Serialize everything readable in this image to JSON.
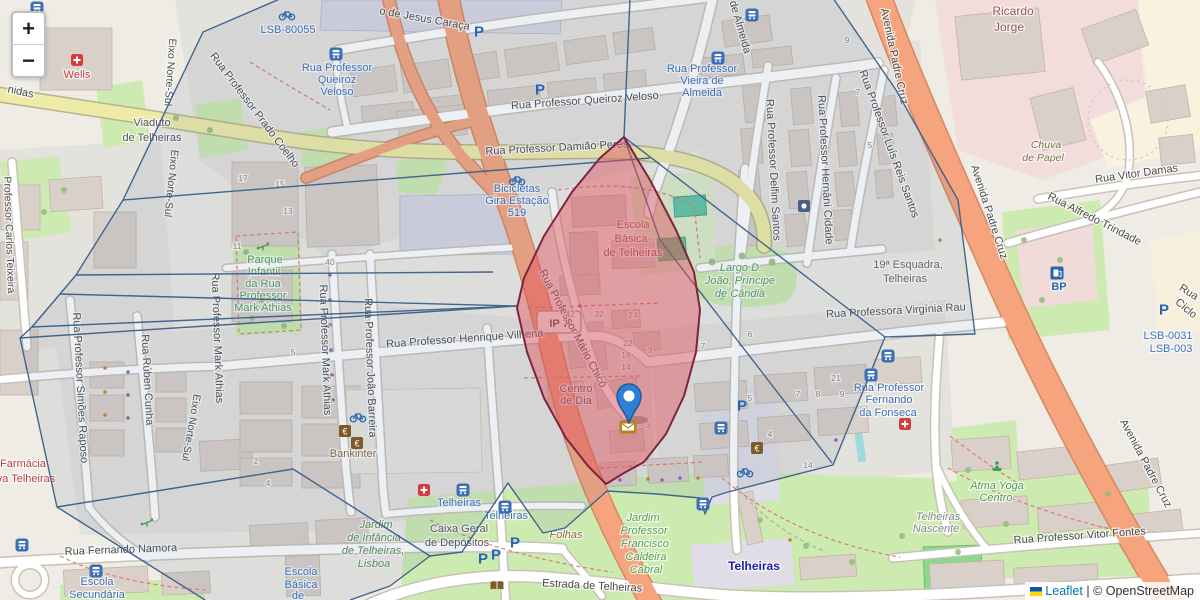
{
  "controls": {
    "zoom_in": "+",
    "zoom_out": "−"
  },
  "attribution": {
    "leaflet": "Leaflet",
    "separator": "|",
    "copyright": "© OpenStreetMap"
  },
  "marker": {
    "x": 629,
    "y": 423
  },
  "colors": {
    "street": "#4b4b4b",
    "blue": "#3b6fb6",
    "green": "#4f9e4f",
    "metro": "#2020a8",
    "gray": "#666666",
    "num": "#8a8a80",
    "red": "#c04040",
    "place": "#a05252",
    "brown": "#8a6d3b",
    "school": "#995233",
    "olive": "#7a7340",
    "dkgray": "#555555",
    "graylt": "#888888",
    "pblue": "#2864b4",
    "grn2": "#5a8a52",
    "overlay_line": "#3a5f8a",
    "highlight_fill": "rgba(226,80,92,0.45)",
    "highlight_border": "#7d2440"
  },
  "map_labels": [
    {
      "t": "nidas",
      "x": 20,
      "y": 95,
      "r": 12
    },
    {
      "t": "Viaduto",
      "x": 152,
      "y": 126,
      "c": "dkgray"
    },
    {
      "t": "de Telheiras",
      "x": 152,
      "y": 141,
      "c": "dkgray"
    },
    {
      "t": "Eixo Norte-Sul",
      "x": 167,
      "y": 72,
      "r": 94,
      "s": 10.5
    },
    {
      "t": "Eixo Norte-Sul",
      "x": 168,
      "y": 183,
      "r": 96,
      "s": 10.5
    },
    {
      "t": "Eixo Norte-Sul",
      "x": 188,
      "y": 427,
      "r": 100,
      "s": 10.5
    },
    {
      "t": "Rua Professor Prado Coelho",
      "x": 252,
      "y": 112,
      "r": 53
    },
    {
      "t": "Rua Professor",
      "x": 337,
      "y": 71,
      "c": "blue"
    },
    {
      "t": "Queiroz",
      "x": 337,
      "y": 83,
      "c": "blue"
    },
    {
      "t": "Veloso",
      "x": 337,
      "y": 95,
      "c": "blue"
    },
    {
      "t": "o de Jesus Caraça",
      "x": 424,
      "y": 22,
      "r": 10
    },
    {
      "t": "Rua Professor Queiroz Veloso",
      "x": 585,
      "y": 104,
      "r": -4
    },
    {
      "t": "Rua Professor Damião Peres",
      "x": 557,
      "y": 151,
      "r": -3
    },
    {
      "t": "Bicicletas",
      "x": 517,
      "y": 192,
      "c": "blue"
    },
    {
      "t": "Gira Estação",
      "x": 517,
      "y": 204,
      "c": "blue"
    },
    {
      "t": "519",
      "x": 517,
      "y": 216,
      "c": "blue"
    },
    {
      "t": "Rua Professor",
      "x": 702,
      "y": 72,
      "c": "blue"
    },
    {
      "t": "Vieira de",
      "x": 702,
      "y": 84,
      "c": "blue"
    },
    {
      "t": "Almeida",
      "x": 702,
      "y": 96,
      "c": "blue"
    },
    {
      "t": "de Almeida",
      "x": 737,
      "y": 28,
      "r": 74
    },
    {
      "t": "Rua Professor Delfim Santos",
      "x": 770,
      "y": 170,
      "r": 87
    },
    {
      "t": "Rua Professor Hernâni Cidade",
      "x": 822,
      "y": 170,
      "r": 87
    },
    {
      "t": "Rua Professor Luís Reis Santos",
      "x": 886,
      "y": 145,
      "r": 70
    },
    {
      "t": "Avenida Padre Cruz",
      "x": 891,
      "y": 57,
      "r": 78
    },
    {
      "t": "Avenida Padre Cruz",
      "x": 986,
      "y": 213,
      "r": 72
    },
    {
      "t": "Avenida Padre Cruz",
      "x": 1143,
      "y": 465,
      "r": 62
    },
    {
      "t": "Ricardo",
      "x": 1013,
      "y": 15,
      "c": "place",
      "s": 12
    },
    {
      "t": "Jorge",
      "x": 1009,
      "y": 31,
      "c": "place",
      "s": 12
    },
    {
      "t": "Chuva",
      "x": 1046,
      "y": 148,
      "c": "olive",
      "i": 1,
      "s": 10.5
    },
    {
      "t": "de Papel",
      "x": 1043,
      "y": 161,
      "c": "olive",
      "i": 1,
      "s": 10.5
    },
    {
      "t": "Rua Vitor Damas",
      "x": 1137,
      "y": 177,
      "r": -8
    },
    {
      "t": "Rua Alfredo Trindade",
      "x": 1093,
      "y": 222,
      "r": 27
    },
    {
      "t": "Rua",
      "x": 1187,
      "y": 295,
      "r": 32
    },
    {
      "t": "Ciclo",
      "x": 1184,
      "y": 311,
      "r": 40
    },
    {
      "t": "LSB-0031",
      "x": 1168,
      "y": 339,
      "c": "blue"
    },
    {
      "t": "LSB-003",
      "x": 1171,
      "y": 352,
      "c": "blue"
    },
    {
      "t": "LSB-80055",
      "x": 288,
      "y": 33,
      "c": "blue"
    },
    {
      "t": "Wells",
      "x": 77,
      "y": 78,
      "c": "red"
    },
    {
      "t": "Farmácia",
      "x": 23,
      "y": 467,
      "c": "red"
    },
    {
      "t": "va Telheiras",
      "x": 26,
      "y": 482,
      "c": "red"
    },
    {
      "t": "IP 7",
      "x": 559,
      "y": 327,
      "c": "dkgray",
      "b": 1
    },
    {
      "t": "Parque",
      "x": 265,
      "y": 263,
      "c": "green"
    },
    {
      "t": "Infantil",
      "x": 264,
      "y": 275,
      "c": "green"
    },
    {
      "t": "da Rua",
      "x": 263,
      "y": 287,
      "c": "green"
    },
    {
      "t": "Professor",
      "x": 263,
      "y": 299,
      "c": "green"
    },
    {
      "t": "Mark Athias",
      "x": 263,
      "y": 311,
      "c": "green"
    },
    {
      "t": "Professor Carlos Teixeira",
      "x": 6,
      "y": 235,
      "r": 88,
      "s": 10.5
    },
    {
      "t": "Rua Professor Simões Raposo",
      "x": 77,
      "y": 388,
      "r": 87
    },
    {
      "t": "Rua Rúben Cunha",
      "x": 144,
      "y": 380,
      "r": 87
    },
    {
      "t": "Rua Professor Mark Athias",
      "x": 214,
      "y": 338,
      "r": 88
    },
    {
      "t": "Rua Professor Mark Athias",
      "x": 322,
      "y": 350,
      "r": 88
    },
    {
      "t": "Rua Professor João Barreira",
      "x": 367,
      "y": 368,
      "r": 88
    },
    {
      "t": "Rua Professor Henrique Vilhena",
      "x": 465,
      "y": 342,
      "r": -4
    },
    {
      "t": "Rua Professor Mário Chicó",
      "x": 570,
      "y": 330,
      "r": 62
    },
    {
      "t": "Centro",
      "x": 576,
      "y": 392,
      "c": "dkgray"
    },
    {
      "t": "de Dia",
      "x": 576,
      "y": 404,
      "c": "dkgray"
    },
    {
      "t": "Escola",
      "x": 633,
      "y": 228,
      "c": "school"
    },
    {
      "t": "· Básica ·",
      "x": 631,
      "y": 242,
      "c": "school"
    },
    {
      "t": "de Telheiras",
      "x": 633,
      "y": 256,
      "c": "school"
    },
    {
      "t": "Largo D.",
      "x": 741,
      "y": 271,
      "c": "green",
      "i": 1
    },
    {
      "t": "João, Príncipe",
      "x": 740,
      "y": 284,
      "c": "green",
      "i": 1
    },
    {
      "t": "de Cândia",
      "x": 740,
      "y": 297,
      "c": "green",
      "i": 1
    },
    {
      "t": "19ª Esquadra,",
      "x": 908,
      "y": 268,
      "c": "gray"
    },
    {
      "t": "Telheiras",
      "x": 905,
      "y": 282,
      "c": "gray"
    },
    {
      "t": "Rua Professora Virgínia Rau",
      "x": 896,
      "y": 314,
      "r": -3
    },
    {
      "t": "Rua Professor",
      "x": 889,
      "y": 391,
      "c": "blue"
    },
    {
      "t": "Fernando",
      "x": 889,
      "y": 403,
      "c": "blue"
    },
    {
      "t": "da Fonseca",
      "x": 888,
      "y": 416,
      "c": "blue"
    },
    {
      "t": "Atma Yoga",
      "x": 997,
      "y": 489,
      "c": "green",
      "i": 1
    },
    {
      "t": "Centro",
      "x": 996,
      "y": 501,
      "c": "green",
      "i": 1
    },
    {
      "t": "Telheiras",
      "x": 938,
      "y": 520,
      "c": "graylt",
      "i": 1
    },
    {
      "t": "Nascente",
      "x": 936,
      "y": 532,
      "c": "graylt",
      "i": 1
    },
    {
      "t": "Rua Professor Vitor Fontes",
      "x": 1080,
      "y": 539,
      "r": -4
    },
    {
      "t": "Rua Fernando Namora",
      "x": 121,
      "y": 553,
      "r": -2
    },
    {
      "t": "Escola",
      "x": 97,
      "y": 585,
      "c": "blue"
    },
    {
      "t": "Secundária",
      "x": 97,
      "y": 598,
      "c": "blue"
    },
    {
      "t": "Escola",
      "x": 301,
      "y": 575,
      "c": "blue"
    },
    {
      "t": "Básica",
      "x": 301,
      "y": 588,
      "c": "blue"
    },
    {
      "t": "de",
      "x": 298,
      "y": 599,
      "c": "blue"
    },
    {
      "t": "Jardim",
      "x": 376,
      "y": 528,
      "c": "grn2",
      "i": 1
    },
    {
      "t": "de Infância",
      "x": 374,
      "y": 541,
      "c": "grn2",
      "i": 1
    },
    {
      "t": "de Telheiras,",
      "x": 373,
      "y": 554,
      "c": "grn2",
      "i": 1
    },
    {
      "t": "Lisboa",
      "x": 374,
      "y": 567,
      "c": "grn2",
      "i": 1
    },
    {
      "t": "Caixa Geral",
      "x": 459,
      "y": 532,
      "c": "dkgray"
    },
    {
      "t": "de Depósitos",
      "x": 457,
      "y": 546,
      "c": "dkgray"
    },
    {
      "t": "Folhas",
      "x": 566,
      "y": 538,
      "c": "brown",
      "i": 1
    },
    {
      "t": "Estrada de Telheiras",
      "x": 592,
      "y": 589,
      "r": 3
    },
    {
      "t": "Telheiras",
      "x": 754,
      "y": 570,
      "c": "metro",
      "b": 1,
      "s": 12
    },
    {
      "t": "Telheiras",
      "x": 459,
      "y": 506,
      "c": "blue"
    },
    {
      "t": "Telheiras",
      "x": 506,
      "y": 519,
      "c": "blue"
    },
    {
      "t": "Bankinter",
      "x": 353,
      "y": 457,
      "c": "brown"
    },
    {
      "t": "Jardim",
      "x": 643,
      "y": 521,
      "c": "green",
      "i": 1
    },
    {
      "t": "Professor",
      "x": 644,
      "y": 534,
      "c": "green",
      "i": 1
    },
    {
      "t": "Francisco",
      "x": 645,
      "y": 547,
      "c": "green",
      "i": 1
    },
    {
      "t": "Caldeira",
      "x": 646,
      "y": 560,
      "c": "green",
      "i": 1
    },
    {
      "t": "Cabral",
      "x": 646,
      "y": 573,
      "c": "green",
      "i": 1
    },
    {
      "t": "BP",
      "x": 1059,
      "y": 290,
      "c": "pblue",
      "b": 1
    },
    {
      "t": "17",
      "x": 243,
      "y": 181,
      "c": "num",
      "s": 8.5
    },
    {
      "t": "15",
      "x": 280,
      "y": 187,
      "c": "num",
      "s": 8.5
    },
    {
      "t": "13",
      "x": 288,
      "y": 214,
      "c": "num",
      "s": 8.5
    },
    {
      "t": "11",
      "x": 237,
      "y": 249,
      "c": "num",
      "s": 8.5
    },
    {
      "t": "40",
      "x": 330,
      "y": 265,
      "c": "num",
      "s": 8.5
    },
    {
      "t": "5",
      "x": 293,
      "y": 355,
      "c": "num",
      "s": 8.5
    },
    {
      "t": "42",
      "x": 570,
      "y": 317,
      "c": "num",
      "s": 8.5
    },
    {
      "t": "32",
      "x": 599,
      "y": 317,
      "c": "num",
      "s": 8.5
    },
    {
      "t": "24",
      "x": 633,
      "y": 318,
      "c": "num",
      "s": 8.5
    },
    {
      "t": "22",
      "x": 628,
      "y": 346,
      "c": "num",
      "s": 8.5
    },
    {
      "t": "18",
      "x": 626,
      "y": 358,
      "c": "num",
      "s": 8.5
    },
    {
      "t": "14",
      "x": 626,
      "y": 370,
      "c": "num",
      "s": 8.5
    },
    {
      "t": "3",
      "x": 650,
      "y": 353,
      "c": "num",
      "s": 8.5
    },
    {
      "t": "6",
      "x": 750,
      "y": 337,
      "c": "num",
      "s": 8.5
    },
    {
      "t": "7",
      "x": 703,
      "y": 349,
      "c": "num",
      "s": 8.5
    },
    {
      "t": "5",
      "x": 750,
      "y": 401,
      "c": "num",
      "s": 8.5
    },
    {
      "t": "9",
      "x": 847,
      "y": 43,
      "c": "num",
      "s": 8.5
    },
    {
      "t": "7",
      "x": 858,
      "y": 95,
      "c": "num",
      "s": 8.5
    },
    {
      "t": "5",
      "x": 870,
      "y": 148,
      "c": "num",
      "s": 8.5
    },
    {
      "t": "2",
      "x": 256,
      "y": 464,
      "c": "num",
      "s": 8.5
    },
    {
      "t": "4",
      "x": 268,
      "y": 486,
      "c": "num",
      "s": 8.5
    },
    {
      "t": "14",
      "x": 808,
      "y": 468,
      "c": "num",
      "s": 8.5
    },
    {
      "t": "21",
      "x": 836,
      "y": 381,
      "c": "num",
      "s": 8.5
    },
    {
      "t": "7",
      "x": 798,
      "y": 397,
      "c": "num",
      "s": 8.5
    },
    {
      "t": "8",
      "x": 818,
      "y": 397,
      "c": "num",
      "s": 8.5
    },
    {
      "t": "9",
      "x": 842,
      "y": 397,
      "c": "num",
      "s": 8.5
    },
    {
      "t": "3",
      "x": 648,
      "y": 428,
      "c": "num",
      "s": 8.5
    },
    {
      "t": "4",
      "x": 770,
      "y": 437,
      "c": "num",
      "s": 8.5
    }
  ],
  "icons": [
    {
      "type": "bus",
      "x": 37,
      "y": 8
    },
    {
      "type": "bus",
      "x": 336,
      "y": 54
    },
    {
      "type": "bus",
      "x": 718,
      "y": 58
    },
    {
      "type": "bus",
      "x": 752,
      "y": 15
    },
    {
      "type": "bus",
      "x": 888,
      "y": 356
    },
    {
      "type": "bus",
      "x": 871,
      "y": 375
    },
    {
      "type": "bus",
      "x": 463,
      "y": 490
    },
    {
      "type": "bus",
      "x": 505,
      "y": 507
    },
    {
      "type": "bus",
      "x": 703,
      "y": 504
    },
    {
      "type": "bus",
      "x": 22,
      "y": 545
    },
    {
      "type": "bus",
      "x": 96,
      "y": 571
    },
    {
      "type": "bus",
      "x": 721,
      "y": 428
    },
    {
      "type": "bike",
      "x": 287,
      "y": 15
    },
    {
      "type": "bike",
      "x": 517,
      "y": 180
    },
    {
      "type": "bike",
      "x": 745,
      "y": 472
    },
    {
      "type": "bike",
      "x": 358,
      "y": 417
    },
    {
      "type": "parking",
      "x": 479,
      "y": 32
    },
    {
      "type": "parking",
      "x": 540,
      "y": 90
    },
    {
      "type": "parking",
      "x": 515,
      "y": 543
    },
    {
      "type": "parking",
      "x": 496,
      "y": 555
    },
    {
      "type": "parking",
      "x": 483,
      "y": 559
    },
    {
      "type": "parking",
      "x": 1164,
      "y": 310
    },
    {
      "type": "parking",
      "x": 742,
      "y": 406
    },
    {
      "type": "pharmacy",
      "x": 77,
      "y": 60
    },
    {
      "type": "pharmacy",
      "x": 424,
      "y": 490
    },
    {
      "type": "pharmacy",
      "x": 905,
      "y": 424
    },
    {
      "type": "fuel",
      "x": 1057,
      "y": 273
    },
    {
      "type": "atm",
      "x": 345,
      "y": 431
    },
    {
      "type": "atm",
      "x": 357,
      "y": 443
    },
    {
      "type": "atm",
      "x": 757,
      "y": 448
    },
    {
      "type": "book",
      "x": 497,
      "y": 586
    },
    {
      "type": "post",
      "x": 628,
      "y": 427
    },
    {
      "type": "yoga",
      "x": 997,
      "y": 467
    },
    {
      "type": "police",
      "x": 804,
      "y": 206
    },
    {
      "type": "playground",
      "x": 147,
      "y": 522
    },
    {
      "type": "playground",
      "x": 263,
      "y": 246
    }
  ]
}
